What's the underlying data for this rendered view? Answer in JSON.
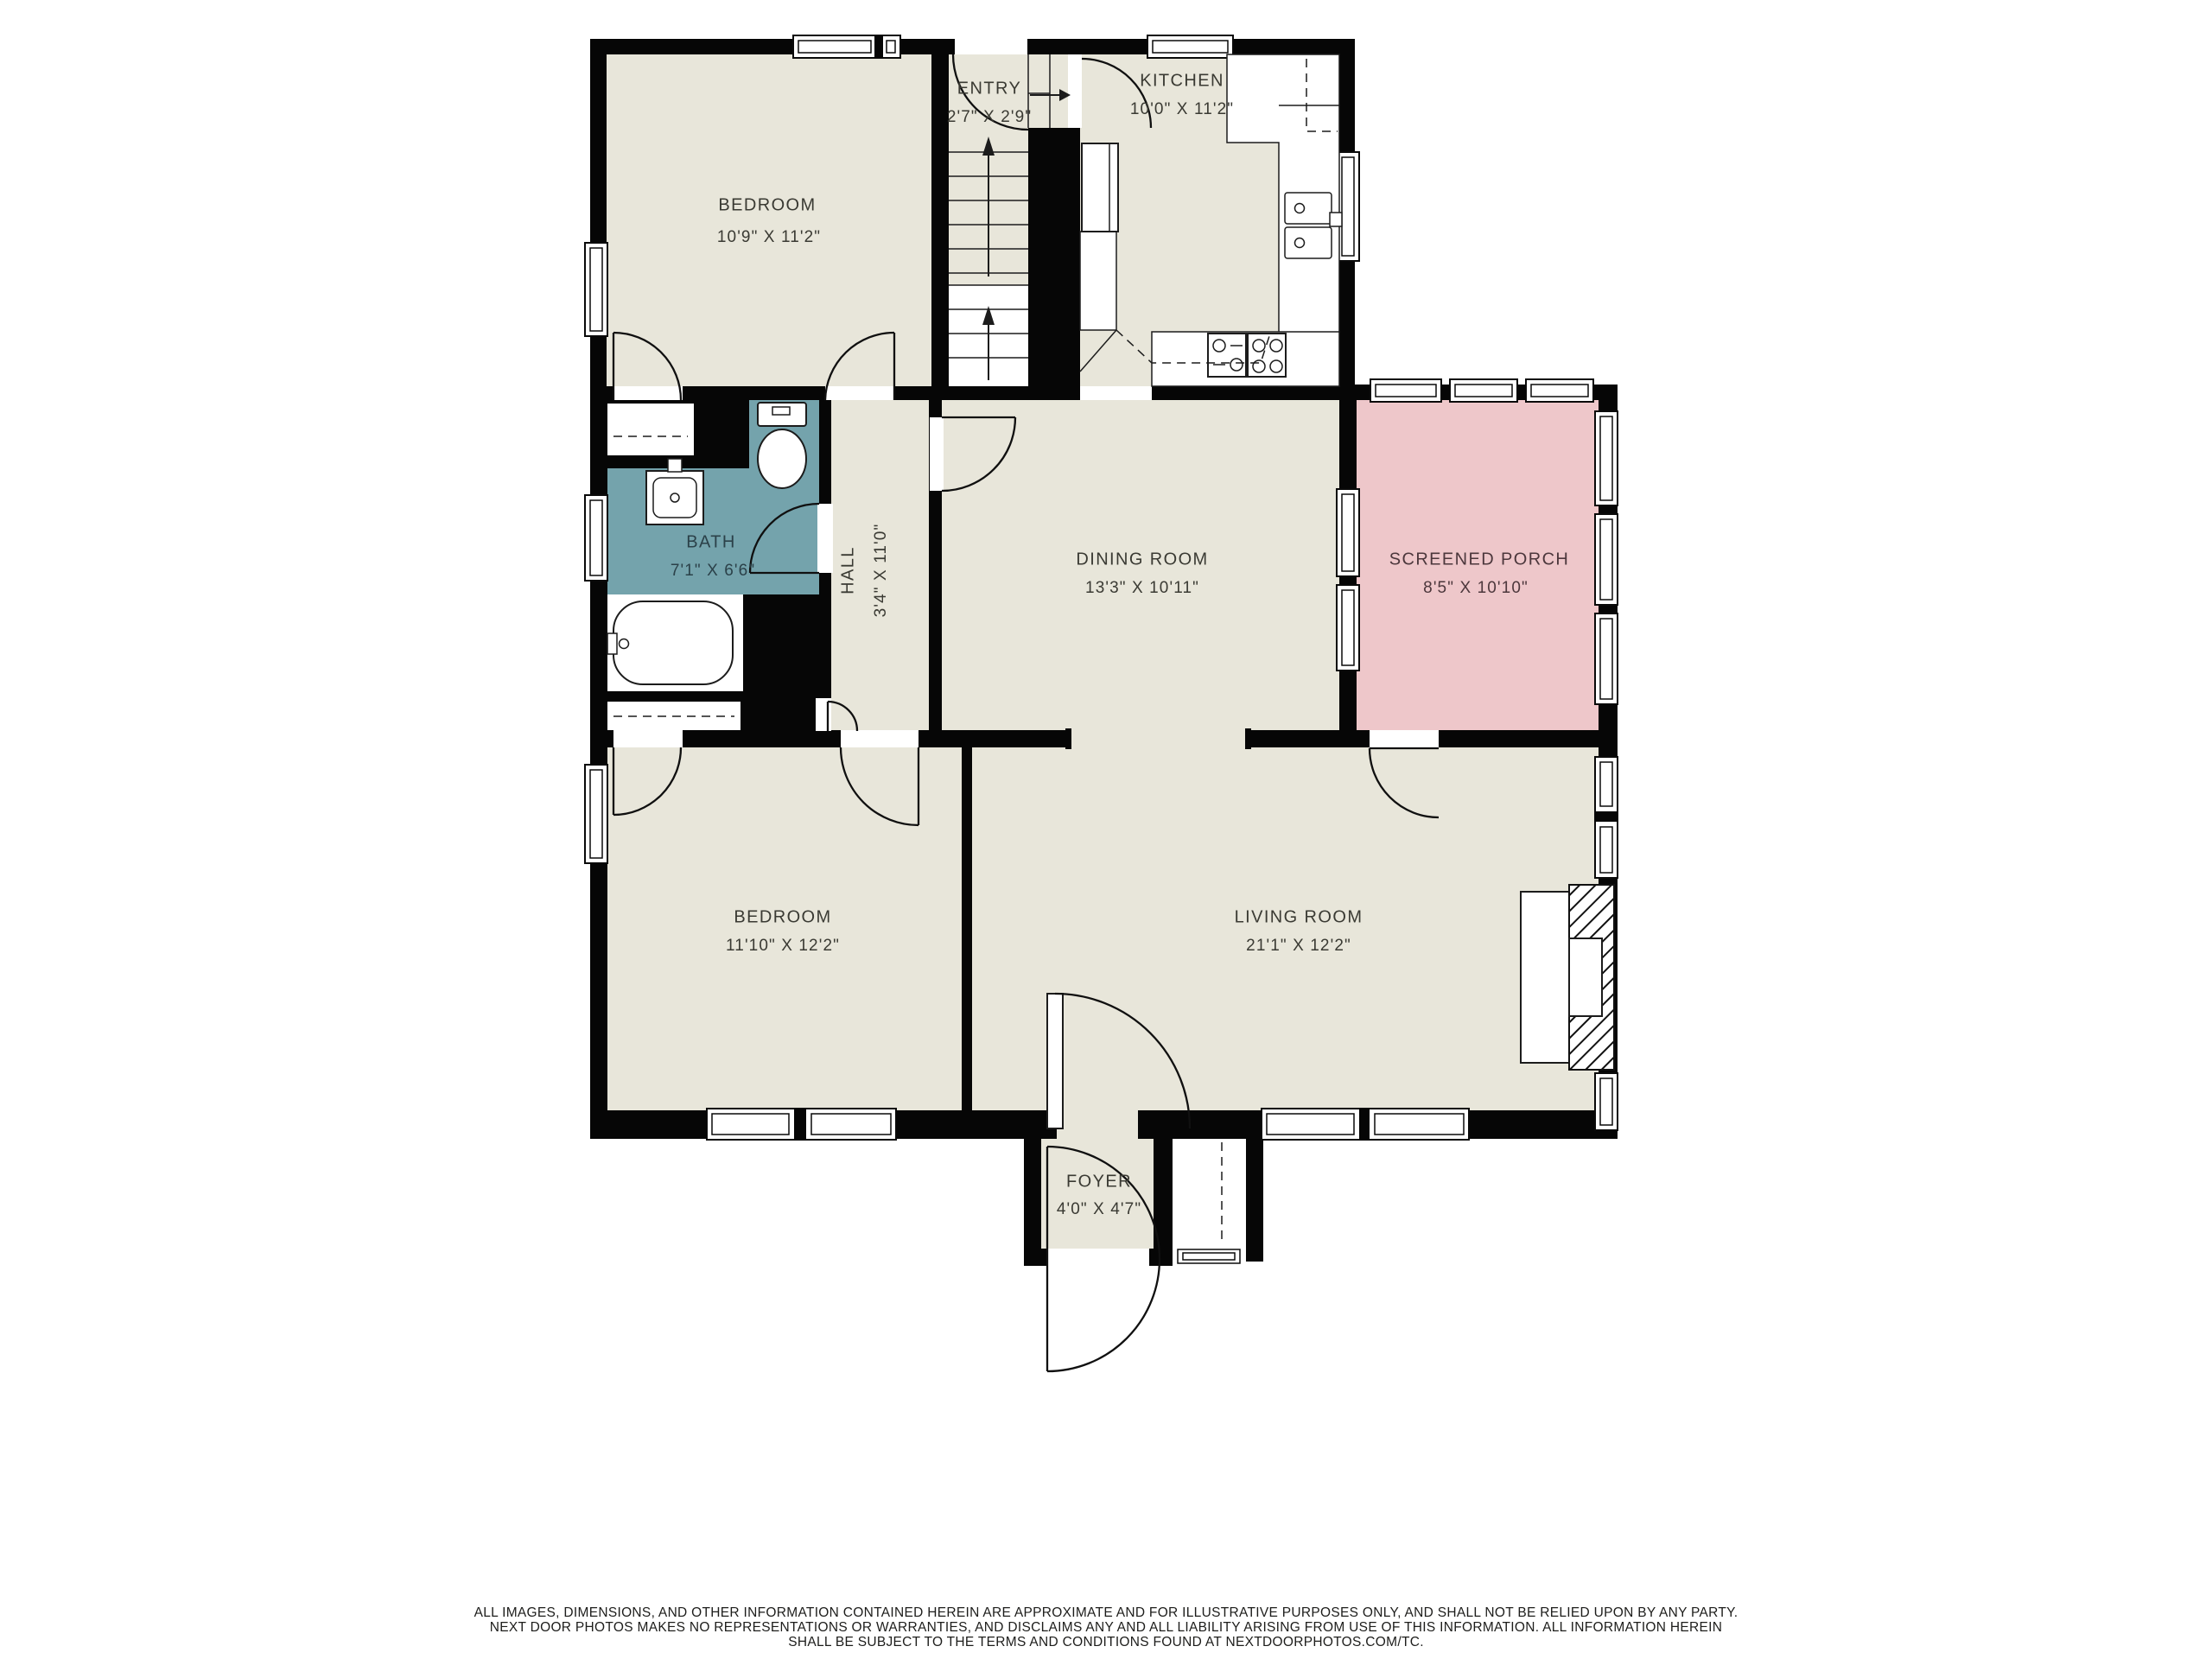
{
  "rooms": {
    "bedroom1": {
      "name": "BEDROOM",
      "dims": "10'9\" X 11'2\""
    },
    "entry": {
      "name": "ENTRY",
      "dims": "2'7\" X 2'9\""
    },
    "kitchen": {
      "name": "KITCHEN",
      "dims": "10'0\" X 11'2\""
    },
    "bath": {
      "name": "BATH",
      "dims": "7'1\" X 6'6\""
    },
    "hall": {
      "name": "HALL",
      "dims": "3'4\" X 11'0\""
    },
    "dining": {
      "name": "DINING ROOM",
      "dims": "13'3\" X 10'11\""
    },
    "screened_porch": {
      "name": "SCREENED PORCH",
      "dims": "8'5\" X 10'10\""
    },
    "bedroom2": {
      "name": "BEDROOM",
      "dims": "11'10\" X 12'2\""
    },
    "living": {
      "name": "LIVING ROOM",
      "dims": "21'1\" X 12'2\""
    },
    "foyer": {
      "name": "FOYER",
      "dims": "4'0\" X 4'7\""
    }
  },
  "disclaimer": {
    "line1": "ALL IMAGES, DIMENSIONS, AND OTHER INFORMATION CONTAINED HEREIN ARE APPROXIMATE AND FOR ILLUSTRATIVE PURPOSES ONLY, AND SHALL NOT BE RELIED UPON BY ANY PARTY.",
    "line2": "NEXT DOOR PHOTOS MAKES NO REPRESENTATIONS OR WARRANTIES, AND DISCLAIMS ANY AND ALL LIABILITY ARISING FROM USE OF THIS INFORMATION. ALL INFORMATION HEREIN",
    "line3": "SHALL BE SUBJECT TO THE TERMS AND CONDITIONS FOUND AT NEXTDOORPHOTOS.COM/TC."
  },
  "colors": {
    "floor": "#e8e6da",
    "wall": "#060606",
    "bath": "#74a3ac",
    "porch": "#eec7ca",
    "label": "#3a3a33",
    "bath-label": "#2b4149",
    "porch-label": "#4c373c",
    "disc": "#1d1d1b"
  }
}
